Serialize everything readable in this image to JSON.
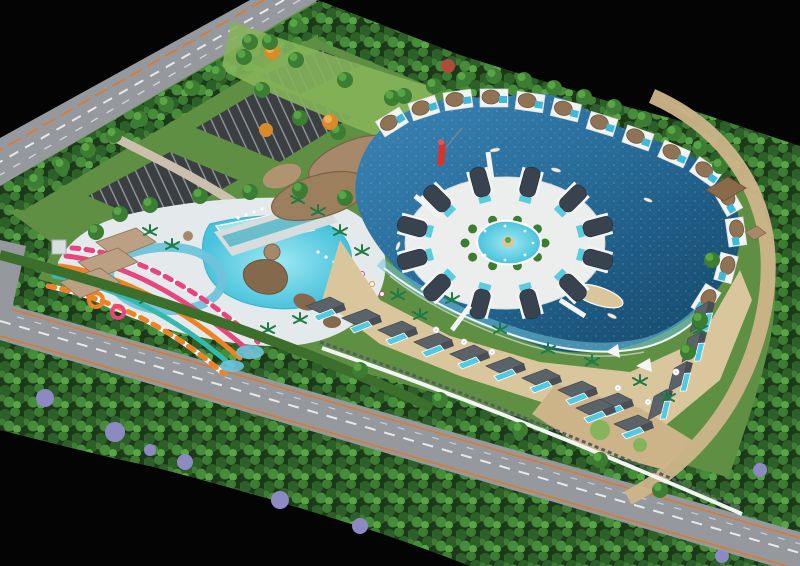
{
  "scene": {
    "title": "Resort water-park master plan — aerial 3D rendering on black backdrop",
    "regions": {
      "background": "black void surrounding the tilted site",
      "perimeter_road_top": "tree-lined arterial road with white dashed lanes and orange line (upper left)",
      "perimeter_road_bottom": "tree-lined arterial road with white dashed lanes and orange edge lines (lower edge)",
      "parking": "surface parking lots with marked stalls near the entrance",
      "entrance_lawn": "entry lawn with green, orange and red ornamental trees",
      "clubhouse": "organic thatched-roof clubhouse and reception pavilions",
      "water_park": "pool complex with wave pool, kids pool, lazy river, rockwork and loungers",
      "slides": "pink, orange, teal and checkered water slides",
      "lagoon": "large free-form blue swimming lagoon with boats and kayaks",
      "island": "central island ring of barrel-roof villas around a round pool",
      "overwater_villas": "white overwater villas with round thatch-dome roofs along the north and east shore",
      "beach": "sand beach with foam waterline, palms, umbrellas and shade sails",
      "south_villas": "rows of gray-roof villas with private plunge pools along the boundary wall",
      "boundary_wall": "white perimeter wall and fence behind the villa rows",
      "east_path": "sand-colored perimeter promenade behind the shore villas",
      "forest": "dense perimeter forest with purple jacaranda accents",
      "hedgerow": "clipped dark-green hedge between the water park and the road",
      "red_sculpture": "red sculptural marker beside the lagoon channel",
      "boats": "small boats and kayaks on the lagoon"
    },
    "counts": {
      "island_villas": 12,
      "overwater_villas": 14,
      "south_villas": 15,
      "parking_lots": 3,
      "slides": 5,
      "boats": 5
    }
  },
  "palette": {
    "bg": "#040404",
    "grass": "#5f8f42",
    "lawn": "#85b45a",
    "road": "#95999d",
    "asphalt": "#3b3f42",
    "lane": "#f2f2f2",
    "laneOrange": "#e0782a",
    "hedge": "#3c6e2c",
    "forestBase": "#1c3a1a",
    "leafDark": "#2d6029",
    "leafMid": "#3c7c33",
    "leafLight": "#57a544",
    "deck": "#e4eaeb",
    "pool": "#52c9df",
    "poolLight": "#9fe3ef",
    "shallow": "#6fc3da",
    "lagoonHi": "#3a85b5",
    "lagoonMid": "#2a6f9d",
    "lagoonLo": "#174a6b",
    "sand": "#d9c69d",
    "sandDeep": "#cdb488",
    "pathSand": "#cdb58a",
    "thatch": "#a5896a",
    "thatchDark": "#7c6245",
    "roofDark": "#39434f",
    "roofGray": "#5b6268",
    "villaWhite": "#f1f4f3",
    "rock": "#84694c",
    "palm": "#1f7a46",
    "purpleTree": "#8d89c2",
    "autumnTree": "#d98a2b",
    "redTree": "#b04a3a",
    "slidePink": "#e8447e",
    "slideOrange": "#f08126",
    "slideTeal": "#35b9ac",
    "sculpture": "#d6342c",
    "boat": "#f0ece2"
  }
}
